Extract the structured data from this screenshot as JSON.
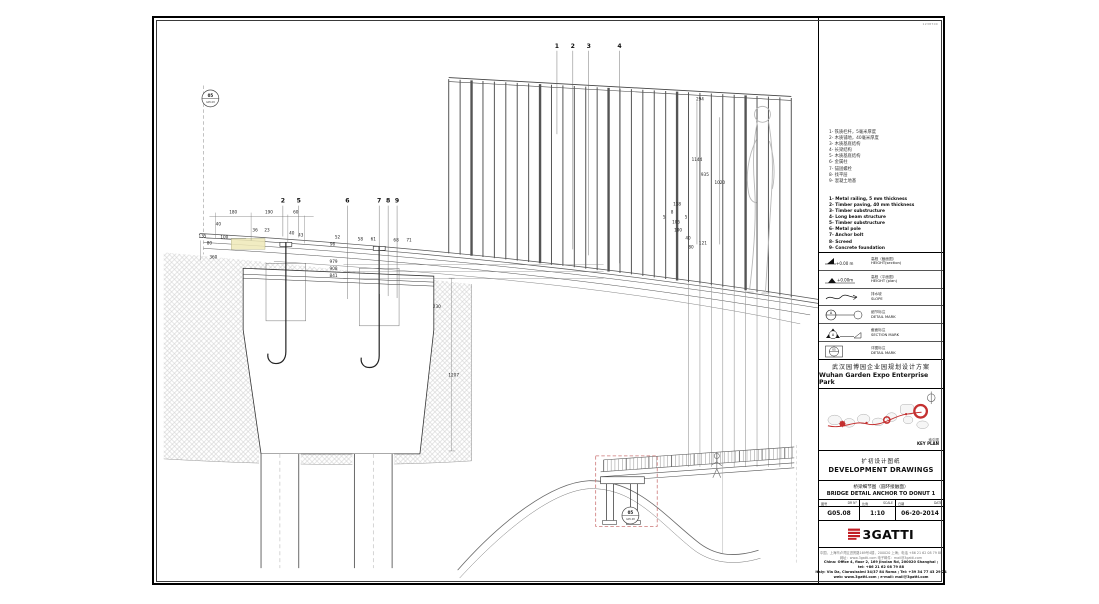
{
  "sheet_ref": "1238700",
  "drawing": {
    "markers": [
      {
        "top": "05",
        "bottom": "G05.08",
        "x": 56,
        "y": 81
      },
      {
        "top": "05",
        "bottom": "G05.08",
        "x": 479,
        "y": 501
      }
    ],
    "callouts_top": [
      {
        "n": "1",
        "x": 405,
        "ly": 117
      },
      {
        "n": "2",
        "x": 421,
        "ly": 233
      },
      {
        "n": "3",
        "x": 437,
        "ly": 239
      },
      {
        "n": "4",
        "x": 468,
        "ly": 247
      }
    ],
    "callouts_deck": [
      {
        "n": "2",
        "x": 129,
        "ly": 220
      },
      {
        "n": "5",
        "x": 145,
        "ly": 221
      },
      {
        "n": "6",
        "x": 194,
        "ly": 283
      },
      {
        "n": "7",
        "x": 226,
        "ly": 278
      },
      {
        "n": "8",
        "x": 235,
        "ly": 280
      },
      {
        "n": "9",
        "x": 244,
        "ly": 282
      }
    ],
    "dimensions": [
      {
        "t": "180",
        "x": 79,
        "y": 197
      },
      {
        "t": "190",
        "x": 115,
        "y": 197
      },
      {
        "t": "60",
        "x": 142,
        "y": 197
      },
      {
        "t": "40",
        "x": 64,
        "y": 209
      },
      {
        "t": "135",
        "x": 48,
        "y": 221
      },
      {
        "t": "80",
        "x": 55,
        "y": 228
      },
      {
        "t": "100",
        "x": 70,
        "y": 222
      },
      {
        "t": "360",
        "x": 59,
        "y": 242
      },
      {
        "t": "36",
        "x": 101,
        "y": 215
      },
      {
        "t": "23",
        "x": 113,
        "y": 215
      },
      {
        "t": "40",
        "x": 138,
        "y": 218
      },
      {
        "t": "43",
        "x": 147,
        "y": 220
      },
      {
        "t": "52",
        "x": 184,
        "y": 222
      },
      {
        "t": "96",
        "x": 179,
        "y": 229
      },
      {
        "t": "58",
        "x": 207,
        "y": 224
      },
      {
        "t": "61",
        "x": 220,
        "y": 224
      },
      {
        "t": "68",
        "x": 243,
        "y": 225
      },
      {
        "t": "71",
        "x": 256,
        "y": 225
      },
      {
        "t": "979",
        "x": 180,
        "y": 247
      },
      {
        "t": "908",
        "x": 180,
        "y": 254
      },
      {
        "t": "841",
        "x": 180,
        "y": 261
      },
      {
        "t": "230",
        "x": 284,
        "y": 292
      },
      {
        "t": "1207",
        "x": 301,
        "y": 361
      },
      {
        "t": "294",
        "x": 549,
        "y": 83
      },
      {
        "t": "1144",
        "x": 546,
        "y": 144
      },
      {
        "t": "935",
        "x": 554,
        "y": 159
      },
      {
        "t": "1020",
        "x": 569,
        "y": 167
      },
      {
        "t": "118",
        "x": 526,
        "y": 189
      },
      {
        "t": "8",
        "x": 521,
        "y": 197
      },
      {
        "t": "5",
        "x": 513,
        "y": 202
      },
      {
        "t": "5",
        "x": 535,
        "y": 202
      },
      {
        "t": "105",
        "x": 525,
        "y": 207
      },
      {
        "t": "100",
        "x": 527,
        "y": 215
      },
      {
        "t": "40",
        "x": 537,
        "y": 223
      },
      {
        "t": "121",
        "x": 552,
        "y": 228
      },
      {
        "t": "80",
        "x": 540,
        "y": 232
      }
    ]
  },
  "titleblock": {
    "notes_cn": [
      "1- 铁质栏杆，5毫米厚度",
      "2- 木质铺地，40毫米厚度",
      "3- 木质基底结构",
      "4- 长梁结构",
      "5- 木质基底结构",
      "6- 金属柱",
      "7- 锚固螺栓",
      "8- 找平层",
      "9- 混凝土地基"
    ],
    "notes_en": [
      "1- Metal railing, 5 mm thickness",
      "2- Timber paving, 40 mm thickness",
      "3- Timber substructure",
      "4- Long beam structure",
      "5- Timber substructure",
      "6- Metal pole",
      "7- Anchor bolt",
      "8- Screed",
      "9- Concrete foundation"
    ],
    "symbols": [
      {
        "mark": "+0.00 m",
        "cn": "高程（截面图）",
        "en": "HEIGHT(section)"
      },
      {
        "mark": "+0.00m",
        "cn": "高程（平面图）",
        "en": "HEIGHT (plan)"
      },
      {
        "mark": "",
        "cn": "排水坡",
        "en": "SLOPE"
      },
      {
        "mark": "A",
        "cn": "细节标注",
        "en": "DETAIL MARK"
      },
      {
        "mark": "A",
        "cn": "截面标注",
        "en": "SECTION MARK"
      },
      {
        "mark": "05",
        "cn": "详图标注",
        "en": "DETAIL MARK"
      }
    ],
    "project_cn": "武汉园博园企业园规划设计方案",
    "project_en": "Wuhan Garden Expo Enterprise Park",
    "keyplan_cn": "索引图",
    "keyplan_en": "KEY PLAN",
    "phase_cn": "扩初设计图纸",
    "phase_en": "DEVELOPMENT DRAWINGS",
    "title_cn": "桥梁细节图（圆环接触面）",
    "title_en": "BRIDGE DETAIL ANCHOR TO DONUT 1",
    "fields": {
      "drno_label_cn": "图号",
      "drno_label_en": "DR N°",
      "drno_value": "G05.08",
      "scale_label_cn": "比例",
      "scale_label_en": "SCALE",
      "scale_value": "1:10",
      "date_label_cn": "日期",
      "date_label_en": "DATE",
      "date_value": "06-20-2014"
    },
    "logo_text": "3GATTI",
    "contact_lines_cn": [
      "中国，上海市卢湾区进贤路169号4楼，200020 上海；电话 +86 21 62 08 79 88",
      "网址：www.3gatti.com 电子邮件：mail@3gatti.com"
    ],
    "contact_lines_en": [
      "China: Office 4, floor 2, 169 Jinxian Rd, 200020 Shanghai ;",
      "tel: +86 21 62 08 79 88",
      "Italy: Via Da, Clarosissimi 34/37 84 Roma ; Tel: +39 34 77 43 29 24",
      "web: www.3gatti.com ; e-mail: mail@3gatti.com"
    ]
  },
  "colors": {
    "accent_red": "#c21f25",
    "keyplan_red": "#c43030",
    "dash_red": "#cc7777",
    "highlight_yellow": "#efe9b8"
  }
}
